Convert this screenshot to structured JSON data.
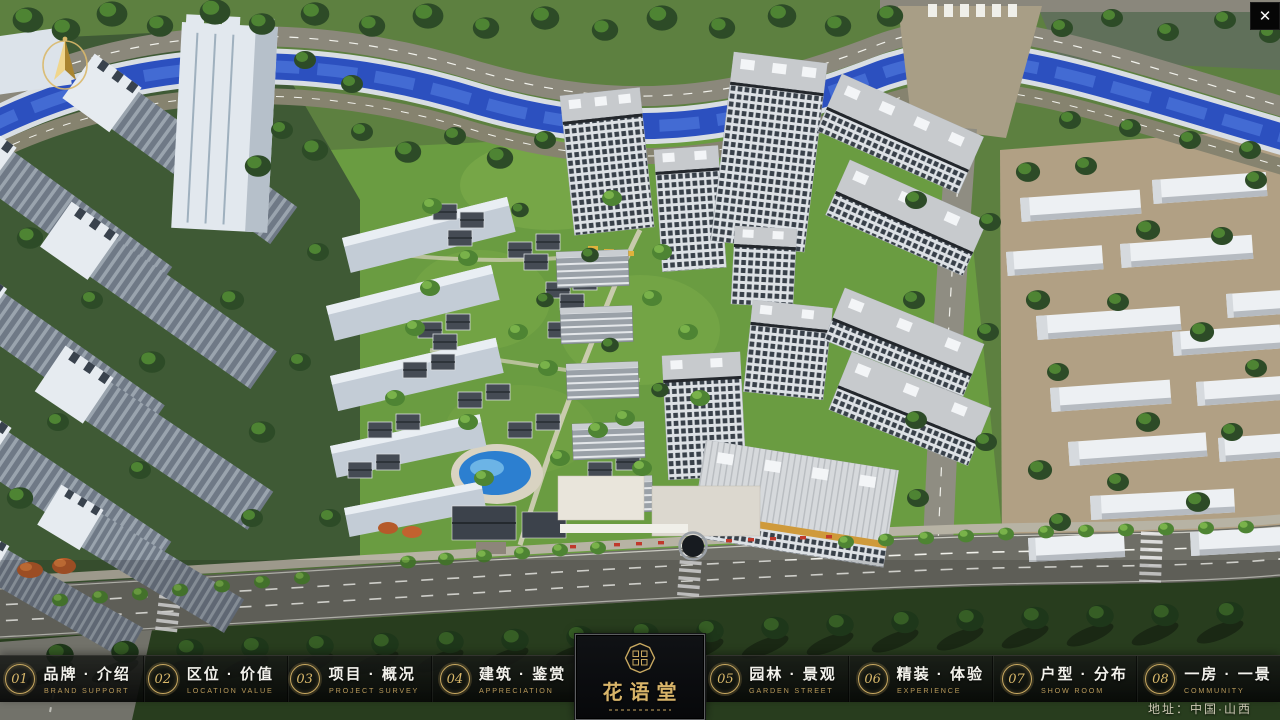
{
  "app": {
    "close_glyph": "✕"
  },
  "nav": {
    "items": [
      {
        "num": "01",
        "zh": "品牌 · 介绍",
        "en": "BRAND SUPPORT"
      },
      {
        "num": "02",
        "zh": "区位 · 价值",
        "en": "LOCATION VALUE"
      },
      {
        "num": "03",
        "zh": "项目 · 概况",
        "en": "PROJECT SURVEY"
      },
      {
        "num": "04",
        "zh": "建筑 · 鉴赏",
        "en": "APPRECIATION"
      },
      {
        "num": "05",
        "zh": "园林 · 景观",
        "en": "GARDEN STREET"
      },
      {
        "num": "06",
        "zh": "精装 · 体验",
        "en": "EXPERIENCE"
      },
      {
        "num": "07",
        "zh": "户型 · 分布",
        "en": "SHOW ROOM"
      },
      {
        "num": "08",
        "zh": "一房 · 一景",
        "en": "COMMUNITY"
      }
    ]
  },
  "logo": {
    "name_zh": "花语堂"
  },
  "footer": {
    "address": "地址：中国·山西"
  },
  "colors": {
    "gold": "#c9a961",
    "gold_dim": "#b99a5b",
    "bar_bg": "#0c0d0c",
    "river_blue": "#2c50bf"
  }
}
